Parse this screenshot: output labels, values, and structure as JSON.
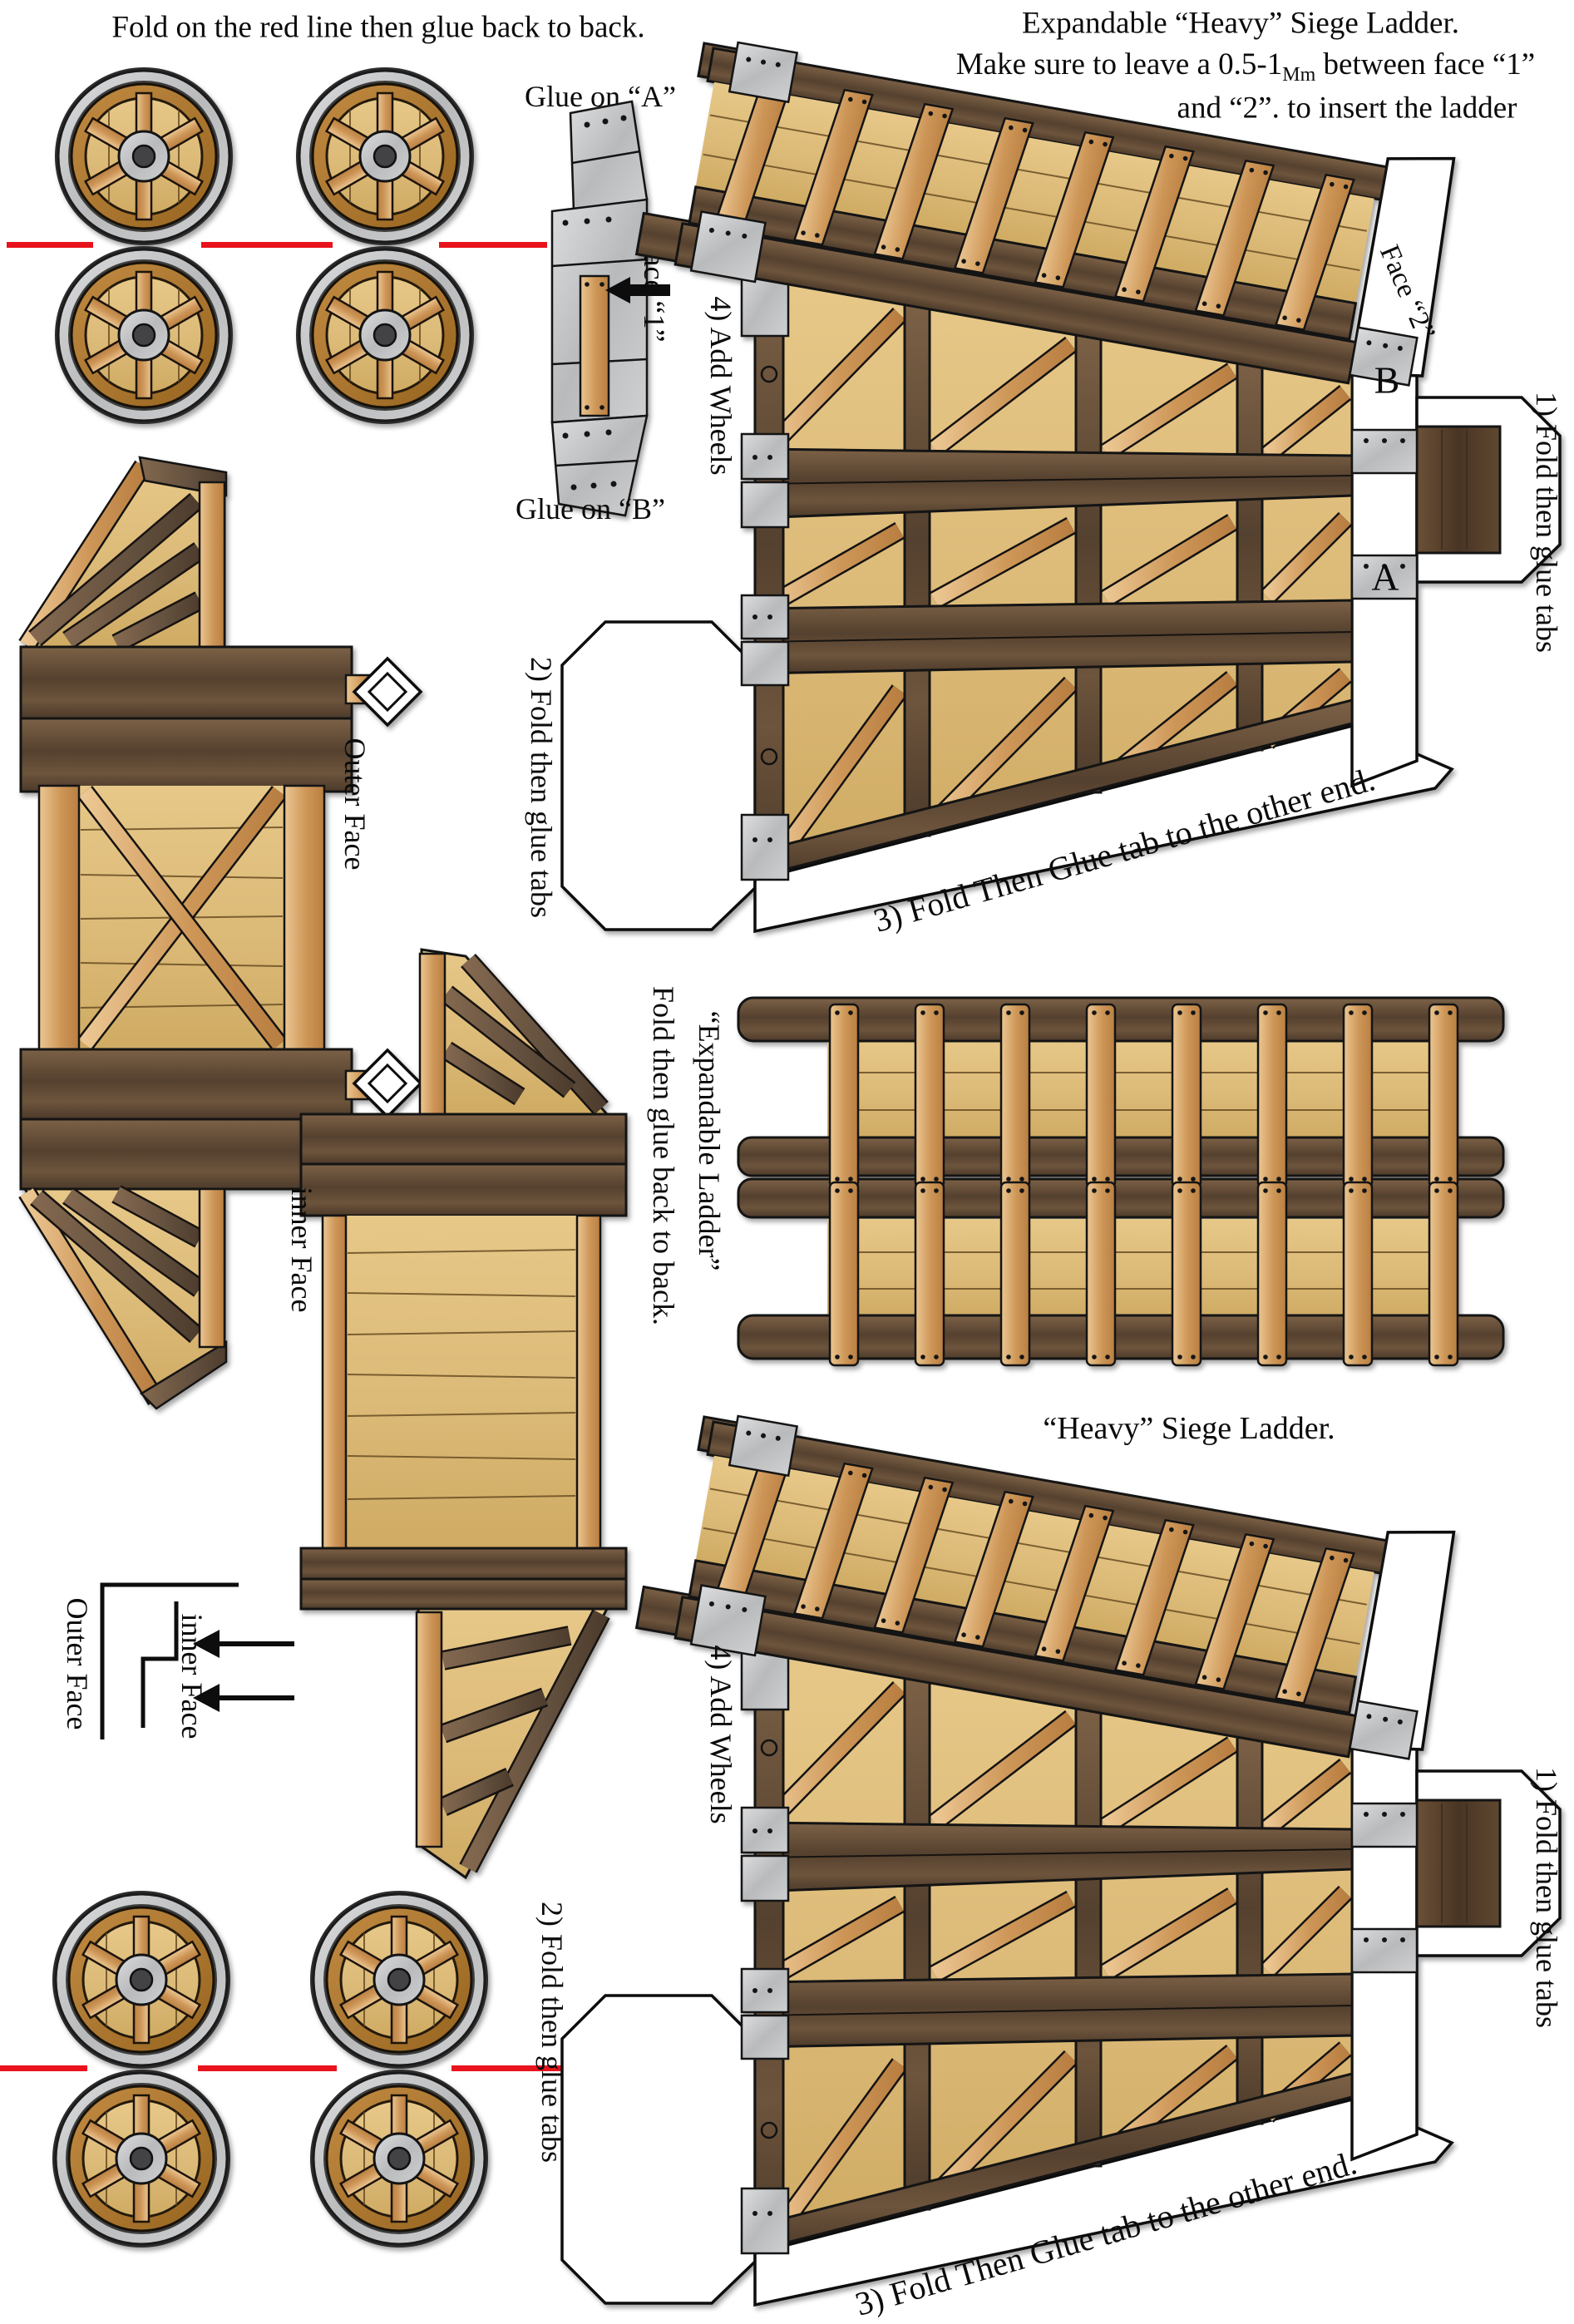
{
  "colors": {
    "background": "#ffffff",
    "fold_line_red": "#e8131c",
    "dark_beam_wood": "#5f4a38",
    "tan_panel_wood": "#ddbc7c",
    "light_rung_wood": "#d9a868",
    "metal_plate_gray": "#c5c6c8",
    "text_black": "#0b0b0b"
  },
  "top_note": "Fold on the red line then glue back to back.",
  "header": {
    "line1": "Expandable “Heavy” Siege Ladder.",
    "line2_pre": "Make sure to leave a 0.5-1",
    "line2_sub": "Mm",
    "line2_post": " between face “1”",
    "line3": "and “2”. to insert the ladder"
  },
  "strip": {
    "glue_a": "Glue on “A”",
    "glue_b": "Glue on “B”",
    "face1": "Face “1”"
  },
  "assembly_top": {
    "step1": "1) Fold then glue tabs",
    "step2": "2) Fold then glue tabs",
    "step3": "3) Fold Then Glue tab to the other end.",
    "step4": "4) Add Wheels",
    "face2": "Face “2”",
    "letter_b": "B",
    "letter_a": "A"
  },
  "assembly_bottom": {
    "title": "“Heavy” Siege Ladder.",
    "step1": "1) Fold then glue tabs",
    "step2": "2) Fold then glue tabs",
    "step3": "3) Fold Then Glue tab to the other end.",
    "step4": "4) Add Wheels"
  },
  "expandable": {
    "label": "“Expandable Ladder”",
    "note": "Fold then glue back to back."
  },
  "faces": {
    "outer_label": "Outer Face",
    "inner_label": "inner Face"
  },
  "legend": {
    "outer": "Outer Face",
    "inner": "inner Face"
  }
}
